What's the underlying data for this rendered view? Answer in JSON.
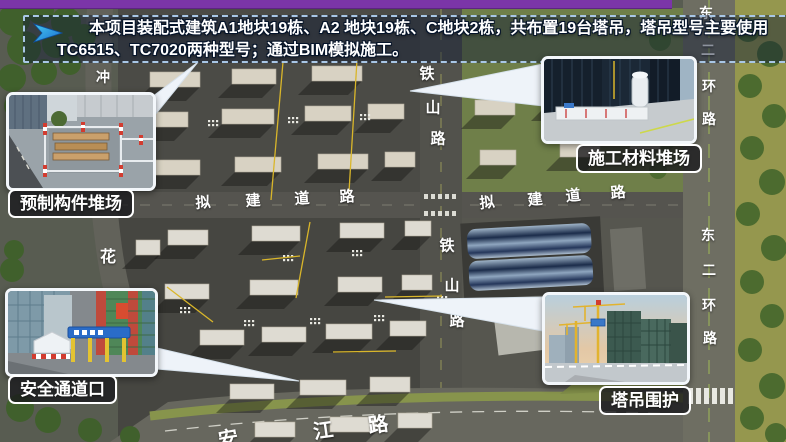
{
  "banner": {
    "line1": "本项目装配式建筑A1地块19栋、A2 地块19栋、C地块2栋，共布置19台塔吊，塔吊型号主要使用",
    "line2": "TC6515、TC7020两种型号；通过BIM模拟施工。",
    "arrow_icon": "blue-paper-plane-arrow"
  },
  "colors": {
    "banner_border": "#a9c7e6",
    "top_bar_purple": "#7b35a8",
    "label_background": "rgba(24,24,28,0.78)",
    "road_text": "#ffffff",
    "crane_line_yellow": "#d9b62a"
  },
  "callouts": [
    {
      "id": "precast-yard",
      "label": "预制构件堆场"
    },
    {
      "id": "material-yard",
      "label": "施工材料堆场"
    },
    {
      "id": "safety-passage",
      "label": "安全通道口"
    },
    {
      "id": "crane-enclosure",
      "label": "塔吊围护"
    }
  ],
  "map": {
    "road_labels": [
      {
        "name": "tieshan-road-upper",
        "text": "铁山路",
        "size": 15,
        "chars": [
          {
            "c": "铁",
            "x": 427,
            "y": 73
          },
          {
            "c": "山",
            "x": 433,
            "y": 107
          },
          {
            "c": "路",
            "x": 438,
            "y": 138
          }
        ]
      },
      {
        "name": "tieshan-road-lower",
        "text": "铁山路",
        "size": 15,
        "chars": [
          {
            "c": "铁",
            "x": 447,
            "y": 245
          },
          {
            "c": "山",
            "x": 452,
            "y": 285
          },
          {
            "c": "路",
            "x": 457,
            "y": 320
          }
        ]
      },
      {
        "name": "planned-road-west",
        "text": "拟建道路",
        "size": 15,
        "chars": [
          {
            "c": "拟",
            "x": 203,
            "y": 202,
            "r": -4
          },
          {
            "c": "建",
            "x": 253,
            "y": 200,
            "r": -4
          },
          {
            "c": "道",
            "x": 302,
            "y": 198,
            "r": -4
          },
          {
            "c": "路",
            "x": 347,
            "y": 196,
            "r": -4
          }
        ]
      },
      {
        "name": "planned-road-east",
        "text": "拟建道路",
        "size": 15,
        "chars": [
          {
            "c": "拟",
            "x": 487,
            "y": 202,
            "r": -6
          },
          {
            "c": "建",
            "x": 535,
            "y": 199,
            "r": -6
          },
          {
            "c": "道",
            "x": 573,
            "y": 195,
            "r": -6
          },
          {
            "c": "路",
            "x": 618,
            "y": 192,
            "r": -6
          }
        ]
      },
      {
        "name": "east-2nd-ring-road-upper",
        "text": "东二环路",
        "size": 14,
        "chars": [
          {
            "c": "东",
            "x": 706,
            "y": 13
          },
          {
            "c": "二",
            "x": 708,
            "y": 50
          },
          {
            "c": "环",
            "x": 709,
            "y": 86
          },
          {
            "c": "路",
            "x": 709,
            "y": 119
          }
        ]
      },
      {
        "name": "east-2nd-ring-road-lower",
        "text": "东二环路",
        "size": 14,
        "chars": [
          {
            "c": "东",
            "x": 708,
            "y": 235
          },
          {
            "c": "二",
            "x": 709,
            "y": 270
          },
          {
            "c": "环",
            "x": 709,
            "y": 305
          },
          {
            "c": "路",
            "x": 710,
            "y": 338
          }
        ]
      },
      {
        "name": "hua-road",
        "text": "花",
        "size": 16,
        "chars": [
          {
            "c": "花",
            "x": 108,
            "y": 255
          }
        ]
      },
      {
        "name": "chong-road",
        "text": "冲",
        "size": 14,
        "chars": [
          {
            "c": "冲",
            "x": 103,
            "y": 77
          }
        ]
      },
      {
        "name": "anjiang-road",
        "text": "安江路",
        "size": 20,
        "chars": [
          {
            "c": "安",
            "x": 228,
            "y": 437,
            "r": -10
          },
          {
            "c": "江",
            "x": 323,
            "y": 429,
            "r": -8
          },
          {
            "c": "路",
            "x": 378,
            "y": 423,
            "r": -8
          }
        ]
      }
    ]
  }
}
